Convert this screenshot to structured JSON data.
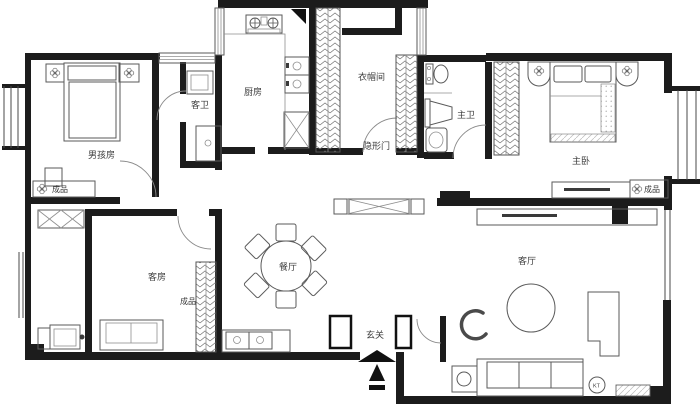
{
  "rooms": {
    "boy_room": {
      "label": "男孩房"
    },
    "guest_bath": {
      "label": "客卫"
    },
    "kitchen": {
      "label": "厨房"
    },
    "cloakroom": {
      "label": "衣帽间"
    },
    "master_bath": {
      "label": "主卫"
    },
    "master_bedroom": {
      "label": "主卧"
    },
    "guest_room": {
      "label": "客房"
    },
    "dining": {
      "label": "餐厅"
    },
    "entrance": {
      "label": "玄关"
    },
    "living": {
      "label": "客厅"
    }
  },
  "annotations": {
    "hidden_door": "隐形门",
    "finished_boy": "成品",
    "finished_guest": "成品",
    "finished_master": "成品",
    "ac_unit": "KT"
  },
  "colors": {
    "wall": "#1c1c1c",
    "furniture_line": "#5a5a5a",
    "light_line": "#9a9a9a",
    "background": "#ffffff"
  }
}
